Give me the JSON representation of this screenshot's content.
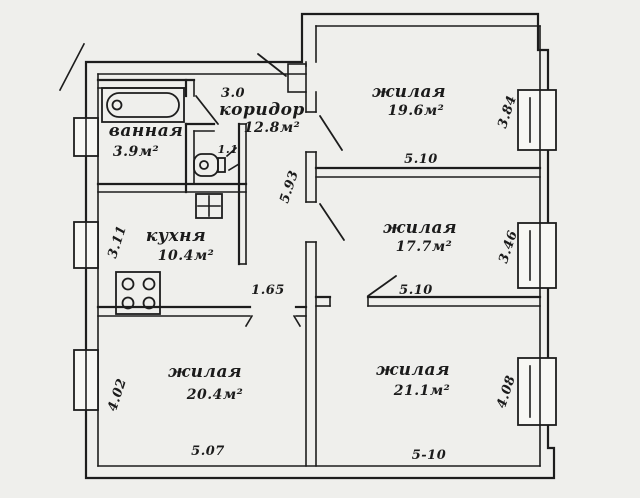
{
  "plan": {
    "rooms": {
      "bathroom": {
        "name": "ванная",
        "area": "3.9м²"
      },
      "wc": {
        "area": "1.1"
      },
      "corridor": {
        "name": "коридор",
        "area": "12.8м²"
      },
      "kitchen": {
        "name": "кухня",
        "area": "10.4м²"
      },
      "living_top_right": {
        "name": "жилая",
        "area": "19.6м²"
      },
      "living_middle_right": {
        "name": "жилая",
        "area": "17.7м²"
      },
      "living_bottom_right": {
        "name": "жилая",
        "area": "21.1м²"
      },
      "living_bottom_left": {
        "name": "жилая",
        "area": "20.4м²"
      }
    },
    "dimensions": {
      "corridor_width": "3.0",
      "corridor_length": "5.93",
      "kitchen_width": "3.11",
      "door_width": "1.65",
      "top_right_width": "5.10",
      "top_right_depth": "3.84",
      "middle_right_width": "5.10",
      "middle_right_depth": "3.46",
      "bottom_right_width": "5-10",
      "bottom_right_depth": "4.08",
      "bottom_left_width": "5.07",
      "bottom_left_depth": "4.02"
    },
    "colors": {
      "ink": "#1d1d1d",
      "paper": "#efefec"
    }
  }
}
